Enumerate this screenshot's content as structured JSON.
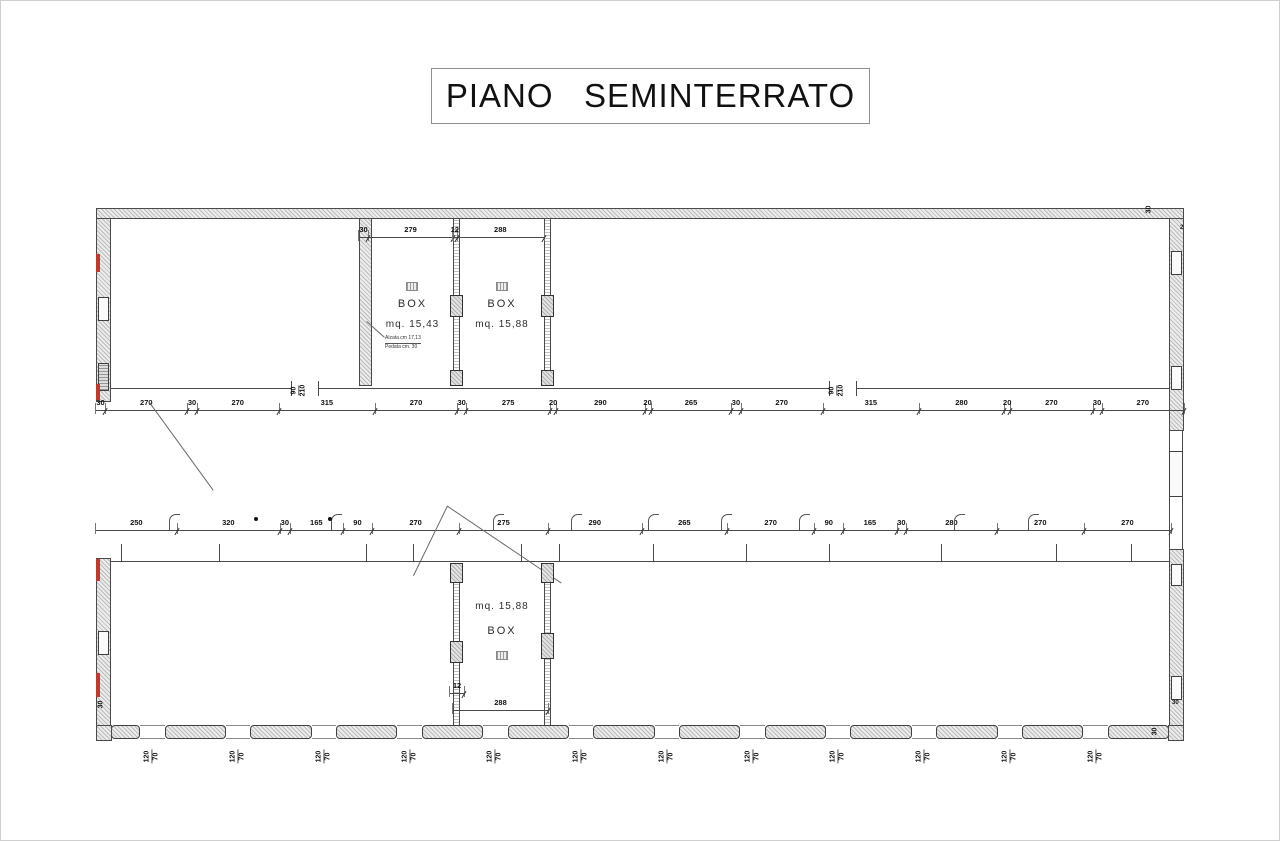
{
  "title": "PIANO   SEMINTERRATO",
  "colors": {
    "line": "#4a4a4a",
    "wall_fill": "#ececec",
    "red_accent": "#c0392b"
  },
  "icons": {
    "grille": "grille-icon",
    "flue": "flue-icon"
  },
  "upper": {
    "box1": {
      "name": "BOX",
      "area": "mq. 15,43"
    },
    "box2": {
      "name": "BOX",
      "area": "mq. 15,88"
    },
    "note_line1": "Alzata cm 17,13",
    "note_line2": "Pedata cm. 30",
    "top_dims1": [
      "30",
      "279"
    ],
    "top_dims2": [
      "12",
      "288"
    ],
    "door_left": {
      "width": "90",
      "height": "210"
    },
    "door_right": {
      "width": "90",
      "height": "210"
    },
    "wall_thickness": "30",
    "corner_note": "2",
    "dim_row": [
      "30",
      "270",
      "30",
      "270",
      "315",
      "270",
      "30",
      "275",
      "20",
      "290",
      "20",
      "265",
      "30",
      "270",
      "315",
      "280",
      "20",
      "270",
      "30",
      "270"
    ]
  },
  "middle": {
    "dim_row": [
      "250",
      "320",
      "30",
      "165",
      "90",
      "270",
      "275",
      "290",
      "265",
      "270",
      "90",
      "165",
      "30",
      "280",
      "270",
      "270"
    ]
  },
  "lower": {
    "box": {
      "name": "BOX",
      "area": "mq. 15,88"
    },
    "dim_partition": [
      "12"
    ],
    "dim_width": [
      "288"
    ],
    "left_corner_thickness": "30",
    "right_wall_thickness": "30",
    "right_corner_thickness": "30",
    "window_label": {
      "top": "120",
      "bottom": "70"
    },
    "window_count": 12
  }
}
